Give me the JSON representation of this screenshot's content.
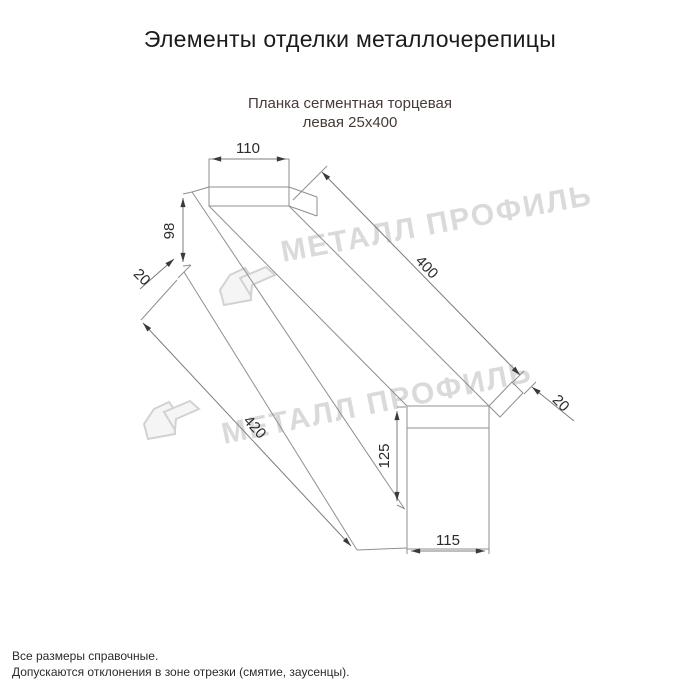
{
  "page": {
    "title": "Элементы отделки металлочерепицы",
    "subtitle_line1": "Планка сегментная торцевая",
    "subtitle_line2": "левая 25х400",
    "footnote_line1": "Все размеры справочные.",
    "footnote_line2": "Допускаются отклонения в зоне отрезки (смятие, заусенцы)."
  },
  "drawing": {
    "type": "technical-dimension-drawing",
    "part_name": "Планка сегментная торцевая левая 25х400",
    "dimensions": {
      "top_width": "110",
      "left_height": "98",
      "left_hem": "20",
      "length_upper": "400",
      "right_hem": "20",
      "length_lower": "420",
      "right_height": "125",
      "bottom_width": "115"
    },
    "colors": {
      "line": "#8f8f8f",
      "dimension_text": "#2b2b2b",
      "subtitle_text": "#473a37",
      "watermark": "#dadada"
    }
  },
  "watermark": {
    "text": "МЕТАЛЛ ПРОФИЛЬ",
    "logo": "house-roof-logo"
  }
}
